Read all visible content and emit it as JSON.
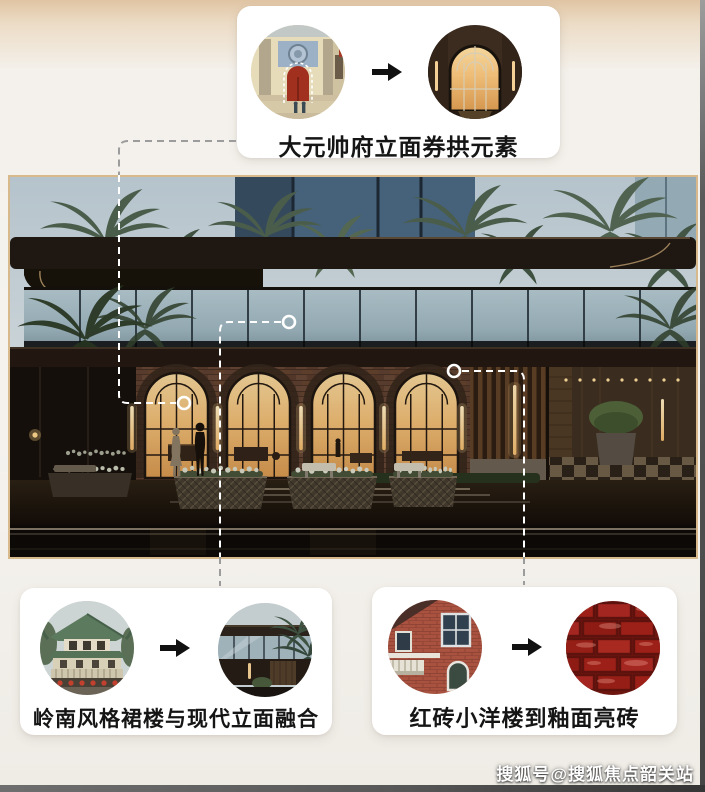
{
  "page": {
    "watermark": "搜狐号@搜狐焦点韶关站",
    "background_top_color": "#e0c4a3",
    "background_color": "#f4f1ec",
    "photo_frame_color": "#d8b98c",
    "card_color": "#ffffff"
  },
  "main_image": {
    "name": "building-facade-render",
    "description": "dusk render of a modern sales-center facade: dark cantilever roof, reflective glass band, four amber-lit brick arch windows, planters with white flowers, lobby with checkered floor",
    "palette": {
      "sky": "#bcc9d1",
      "glass_band": "#a6b9c1",
      "brick": "#5d3f30",
      "arch_glow": "#eebd77",
      "canopy": "#1e1712"
    }
  },
  "callouts": {
    "top": {
      "label": "大元帅府立面券拱元素",
      "left_image": "historic-mansion-arch-gate-photo",
      "right_image": "modern-arched-doorway-render",
      "arrow_icon": "right-arrow"
    },
    "bottom_left": {
      "label": "岭南风格裙楼与现代立面融合",
      "left_image": "lingnan-style-green-roof-building-photo",
      "right_image": "modern-glass-podium-render",
      "arrow_icon": "right-arrow"
    },
    "bottom_right": {
      "label": "红砖小洋楼到釉面亮砖",
      "left_image": "red-brick-western-house-photo",
      "right_image": "glazed-red-brick-texture-photo",
      "arrow_icon": "right-arrow"
    }
  }
}
